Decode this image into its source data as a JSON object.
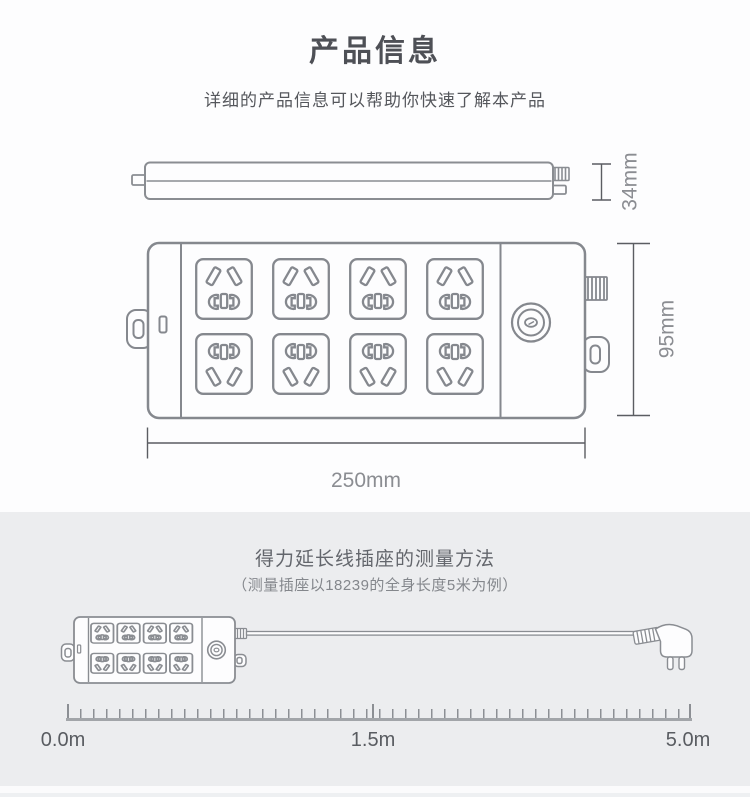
{
  "product_info": {
    "title": "产品信息",
    "subtitle": "详细的产品信息可以帮助你快速了解本产品",
    "dimensions": {
      "height": "34mm",
      "depth": "95mm",
      "width": "250mm"
    }
  },
  "measurement": {
    "title": "得力延长线插座的测量方法",
    "subtitle": "（测量插座以18239的全身长度5米为例）",
    "ruler": {
      "start": "0.0m",
      "middle": "1.5m",
      "end": "5.0m"
    }
  },
  "illustrations": {
    "side_view": "power-strip-side-view",
    "top_view": "power-strip-top-view-8-outlets",
    "measure_diagram": "power-strip-with-cord-and-plug"
  },
  "colors": {
    "line_art": "#85888e",
    "dimension_line": "#5b5d62",
    "dimension_text": "#8b8d92",
    "section_background": "#ecedef",
    "page_background": "#fdfdfe"
  }
}
